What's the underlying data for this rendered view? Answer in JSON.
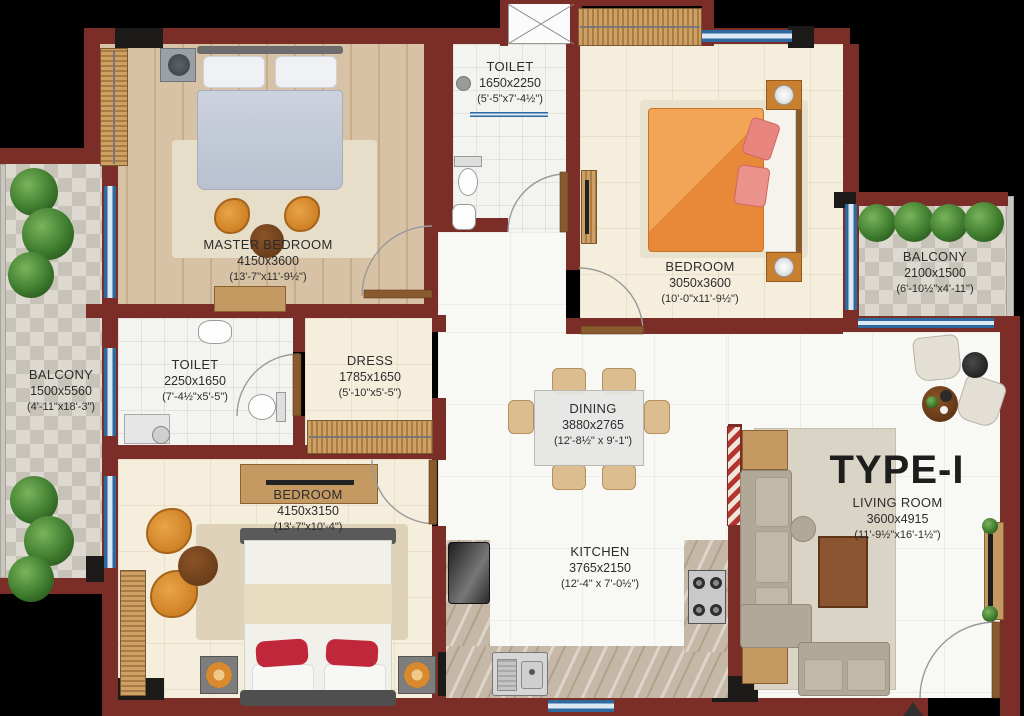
{
  "title": "TYPE-I",
  "rooms": {
    "master_bedroom": {
      "name": "MASTER BEDROOM",
      "mm": "4150x3600",
      "ft": "(13'-7\"x11'-9½\")"
    },
    "toilet_top": {
      "name": "TOILET",
      "mm": "1650x2250",
      "ft": "(5'-5\"x7'-4½\")"
    },
    "bedroom_top": {
      "name": "BEDROOM",
      "mm": "3050x3600",
      "ft": "(10'-0\"x11'-9½\")"
    },
    "balcony_right": {
      "name": "BALCONY",
      "mm": "2100x1500",
      "ft": "(6'-10½\"x4'-11\")"
    },
    "balcony_left": {
      "name": "BALCONY",
      "mm": "1500x5560",
      "ft": "(4'-11\"x18'-3\")"
    },
    "toilet_left": {
      "name": "TOILET",
      "mm": "2250x1650",
      "ft": "(7'-4½\"x5'-5\")"
    },
    "dress": {
      "name": "DRESS",
      "mm": "1785x1650",
      "ft": "(5'-10\"x5'-5\")"
    },
    "dining": {
      "name": "DINING",
      "mm": "3880x2765",
      "ft": "(12'-8½\" x 9'-1\")"
    },
    "bedroom_bottom": {
      "name": "BEDROOM",
      "mm": "4150x3150",
      "ft": "(13'-7\"x10'-4\")"
    },
    "kitchen": {
      "name": "KITCHEN",
      "mm": "3765x2150",
      "ft": "(12'-4\" x 7'-0½\")"
    },
    "living_room": {
      "name": "LIVING ROOM",
      "mm": "3600x4915",
      "ft": "(11'-9½\"x16'-1½\")"
    }
  },
  "colors": {
    "wall": "#7b2d27",
    "window": "#2e6aa0",
    "column": "#1d1b19",
    "wood_floor": "#d8c2a6",
    "cream_tile": "#f5eedd",
    "marble": "#f8f8f5",
    "balcony_tile": "#ddd9d1",
    "bed_orange": "#ea9140",
    "pillow_red": "#c1273a",
    "sofa": "#b2a898",
    "plant": "#3f7c2e"
  }
}
